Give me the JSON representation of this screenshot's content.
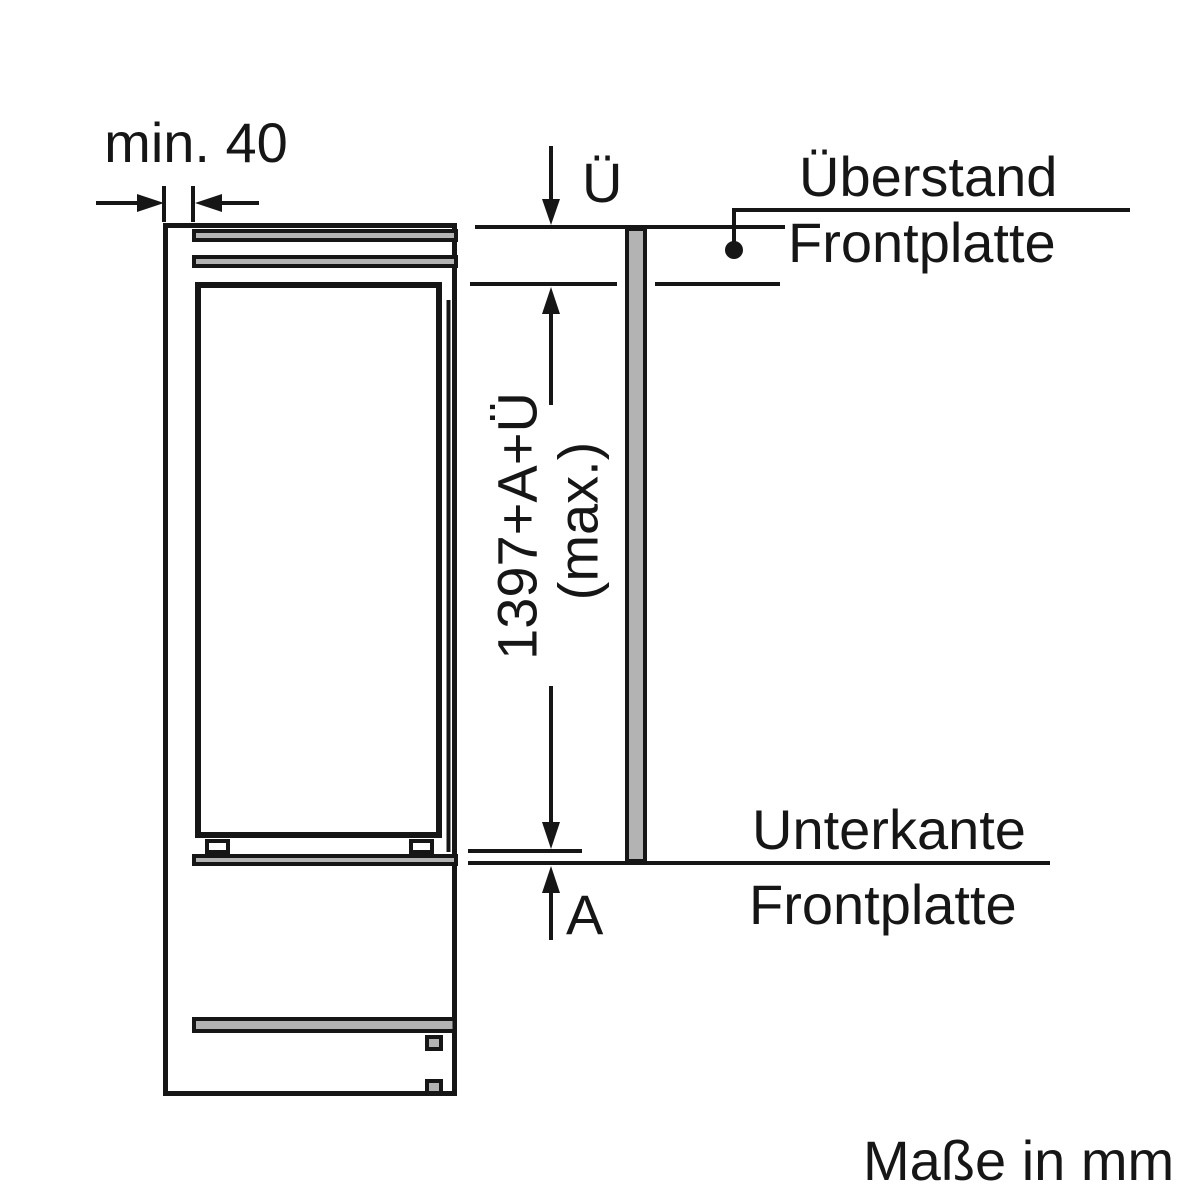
{
  "diagram": {
    "type": "appliance-installation-dimension-drawing",
    "units_note": "Maße in mm",
    "labels": {
      "min_gap": "min. 40",
      "overhang_symbol": "Ü",
      "overhang_name_line1": "Überstand",
      "overhang_name_line2": "Frontplatte",
      "height_dim_line1": "1397+A+Ü",
      "height_dim_line2": "(max.)",
      "bottom_edge_line1": "Unterkante",
      "bottom_edge_line2": "Frontplatte",
      "recess_symbol": "A"
    },
    "colors": {
      "line": "#161616",
      "panel_fill": "#b3b3b3",
      "background": "#ffffff"
    }
  }
}
